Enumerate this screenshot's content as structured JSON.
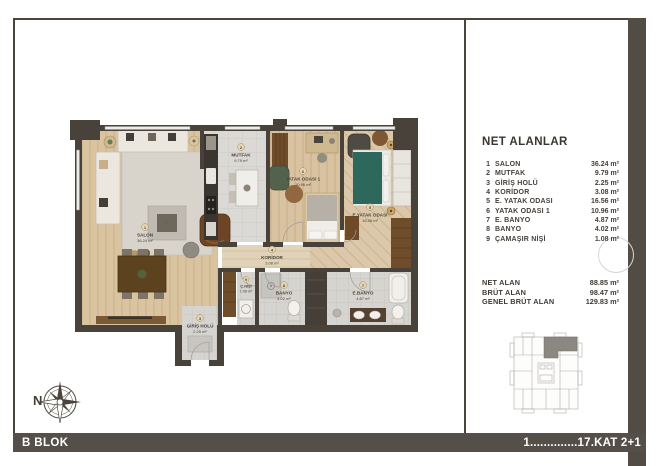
{
  "legend": {
    "title": "NET ALANLAR",
    "rooms": [
      {
        "no": "1",
        "name": "SALON",
        "plan_name": "SALON",
        "area": "36.24 m²"
      },
      {
        "no": "2",
        "name": "MUTFAK",
        "plan_name": "MUTFAK",
        "area": "9.79 m²"
      },
      {
        "no": "3",
        "name": "GİRİŞ HOLÜ",
        "plan_name": "GİRİŞ HOLÜ",
        "area": "2.25 m²"
      },
      {
        "no": "4",
        "name": "KORİDOR",
        "plan_name": "KORİDOR",
        "area": "3.08 m²"
      },
      {
        "no": "5",
        "name": "E. YATAK ODASI",
        "plan_name": "E.YATAK ODASI",
        "area": "16.56 m²"
      },
      {
        "no": "6",
        "name": "YATAK ODASI 1",
        "plan_name": "YATAK ODASI 1",
        "area": "10.96 m²"
      },
      {
        "no": "7",
        "name": "E. BANYO",
        "plan_name": "E.BANYO",
        "area": "4.87 m²"
      },
      {
        "no": "8",
        "name": "BANYO",
        "plan_name": "BANYO",
        "area": "4.02 m²"
      },
      {
        "no": "9",
        "name": "ÇAMAŞIR NİŞİ",
        "plan_name": "Ç.NİŞİ",
        "area": "1.08 m²"
      }
    ],
    "totals": [
      {
        "label": "NET ALAN",
        "value": "88.85 m²"
      },
      {
        "label": "BRÜT ALAN",
        "value": "98.47 m²"
      },
      {
        "label": "GENEL BRÜT ALAN",
        "value": "129.83 m²"
      }
    ]
  },
  "footer": {
    "left_label": "B BLOK",
    "right_label": "1..............17.KAT 2+1"
  },
  "compass": {
    "north_label": "N"
  },
  "colors": {
    "wall": "#48423a",
    "footer_bar": "#554f49",
    "highlight_unit": "#8b8781",
    "bed_teal": "#2e685d"
  }
}
